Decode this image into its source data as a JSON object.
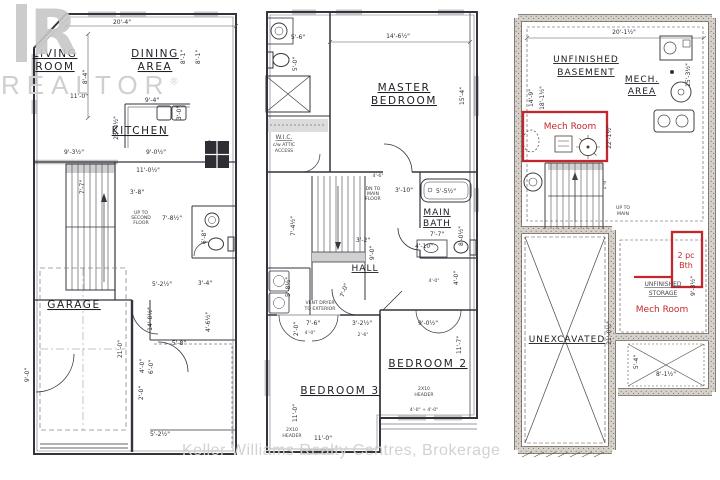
{
  "colors": {
    "annotation_red": "#c2272d",
    "plan_line": "#34343d",
    "watermark_gray": "#cfcfcf"
  },
  "watermarks": {
    "logo_letter": "R",
    "realtor": "REALTOR",
    "registered": "®",
    "footer": "Keller Williams Realty Centres, Brokerage"
  },
  "floor1": {
    "title": "Main Floor",
    "labels": [
      {
        "t": "LIVING",
        "x": 55,
        "y": 57,
        "c": "room"
      },
      {
        "t": "ROOM",
        "x": 55,
        "y": 70,
        "c": "room"
      },
      {
        "t": "DINING",
        "x": 155,
        "y": 57,
        "c": "room"
      },
      {
        "t": "AREA",
        "x": 155,
        "y": 70,
        "c": "room"
      },
      {
        "t": "KITCHEN",
        "x": 140,
        "y": 134,
        "c": "room"
      },
      {
        "t": "GARAGE",
        "x": 74,
        "y": 308,
        "c": "room"
      },
      {
        "t": "20'-4\"",
        "x": 122,
        "y": 24,
        "c": "dim"
      },
      {
        "t": "8'-4\"",
        "x": 87,
        "y": 77,
        "r": -90,
        "c": "dim"
      },
      {
        "t": "11'-0\"",
        "x": 79,
        "y": 98,
        "c": "dim"
      },
      {
        "t": "8'-1\"",
        "x": 185,
        "y": 57,
        "r": -90,
        "c": "dim"
      },
      {
        "t": "8'-1\"",
        "x": 200,
        "y": 57,
        "r": -90,
        "c": "dim"
      },
      {
        "t": "9'-4\"",
        "x": 152,
        "y": 102,
        "c": "dim"
      },
      {
        "t": "3'-0\"",
        "x": 181,
        "y": 113,
        "r": -90,
        "c": "dim"
      },
      {
        "t": "23'-4½\"",
        "x": 118,
        "y": 128,
        "r": -90,
        "c": "dim"
      },
      {
        "t": "9'-0½\"",
        "x": 156,
        "y": 154,
        "c": "dim"
      },
      {
        "t": "9'-3½\"",
        "x": 74,
        "y": 154,
        "c": "dim"
      },
      {
        "t": "6'-4\"",
        "x": 213,
        "y": 147,
        "r": -90,
        "c": "dim"
      },
      {
        "t": "11'-0½\"",
        "x": 148,
        "y": 172,
        "c": "dim"
      },
      {
        "t": "3'-8\"",
        "x": 137,
        "y": 194,
        "c": "dim"
      },
      {
        "t": "UP TO",
        "x": 141,
        "y": 214,
        "c": "tiny"
      },
      {
        "t": "SECOND",
        "x": 141,
        "y": 219,
        "c": "tiny"
      },
      {
        "t": "FLOOR",
        "x": 141,
        "y": 224,
        "c": "tiny"
      },
      {
        "t": "7'-8½\"",
        "x": 172,
        "y": 220,
        "c": "dim"
      },
      {
        "t": "7'-7\"",
        "x": 84,
        "y": 187,
        "r": -90,
        "c": "dim"
      },
      {
        "t": "6'-8\"",
        "x": 206,
        "y": 237,
        "r": -90,
        "c": "dim"
      },
      {
        "t": "5'-2½\"",
        "x": 162,
        "y": 286,
        "c": "dim"
      },
      {
        "t": "3'-4\"",
        "x": 205,
        "y": 285,
        "c": "dim"
      },
      {
        "t": "14'-0½\"",
        "x": 152,
        "y": 319,
        "r": -90,
        "c": "dim"
      },
      {
        "t": "4'-6½\"",
        "x": 210,
        "y": 322,
        "r": -90,
        "c": "dim"
      },
      {
        "t": "21'-0\"",
        "x": 122,
        "y": 349,
        "r": -90,
        "c": "dim"
      },
      {
        "t": "5'-8\"",
        "x": 179,
        "y": 345,
        "c": "dim"
      },
      {
        "t": "4'-0\"",
        "x": 144,
        "y": 366,
        "r": -90,
        "c": "dim"
      },
      {
        "t": "6'-0\"",
        "x": 153,
        "y": 367,
        "r": -90,
        "c": "dim"
      },
      {
        "t": "2'-0\"",
        "x": 143,
        "y": 393,
        "r": -90,
        "c": "dim"
      },
      {
        "t": "9'-0\"",
        "x": 29,
        "y": 375,
        "r": -90,
        "c": "dim"
      },
      {
        "t": "5'-2½\"",
        "x": 160,
        "y": 436,
        "c": "dim"
      }
    ]
  },
  "floor2": {
    "title": "Second Floor",
    "labels": [
      {
        "t": "MASTER",
        "x": 404,
        "y": 91,
        "c": "room"
      },
      {
        "t": "BEDROOM",
        "x": 404,
        "y": 104,
        "c": "room"
      },
      {
        "t": "W.I.C.",
        "x": 284,
        "y": 139,
        "c": "tiny2"
      },
      {
        "t": "c/w ATTIC",
        "x": 284,
        "y": 146,
        "c": "tiny"
      },
      {
        "t": "ACCESS",
        "x": 284,
        "y": 152,
        "c": "tiny"
      },
      {
        "t": "5'-6\"",
        "x": 298,
        "y": 39,
        "c": "dim"
      },
      {
        "t": "5'-0\"",
        "x": 297,
        "y": 64,
        "r": -90,
        "c": "dim"
      },
      {
        "t": "14'-6½\"",
        "x": 398,
        "y": 38,
        "c": "dim"
      },
      {
        "t": "15'-4\"",
        "x": 464,
        "y": 96,
        "r": -90,
        "c": "dim"
      },
      {
        "t": "DN TO",
        "x": 373,
        "y": 190,
        "c": "tiny"
      },
      {
        "t": "MAIN",
        "x": 373,
        "y": 195,
        "c": "tiny"
      },
      {
        "t": "FLOOR",
        "x": 373,
        "y": 200,
        "c": "tiny"
      },
      {
        "t": "4'-6\"",
        "x": 378,
        "y": 177,
        "c": "tiny"
      },
      {
        "t": "3'-10\"",
        "x": 404,
        "y": 192,
        "c": "dim"
      },
      {
        "t": "5'-5½\"",
        "x": 446,
        "y": 193,
        "c": "dim"
      },
      {
        "t": "MAIN",
        "x": 437,
        "y": 215,
        "c": "room-s"
      },
      {
        "t": "BATH",
        "x": 437,
        "y": 226,
        "c": "room-s"
      },
      {
        "t": "7'-7\"",
        "x": 437,
        "y": 236,
        "c": "dim"
      },
      {
        "t": "7'-4½\"",
        "x": 295,
        "y": 226,
        "r": -90,
        "c": "dim"
      },
      {
        "t": "3'-2\"",
        "x": 363,
        "y": 242,
        "c": "dim"
      },
      {
        "t": "9'-0\"",
        "x": 374,
        "y": 253,
        "r": -90,
        "c": "dim"
      },
      {
        "t": "4'-10\"",
        "x": 424,
        "y": 248,
        "c": "dim"
      },
      {
        "t": "8'-0½\"",
        "x": 463,
        "y": 236,
        "r": -90,
        "c": "dim"
      },
      {
        "t": "HALL",
        "x": 365,
        "y": 271,
        "c": "room-s"
      },
      {
        "t": "5'-8½\"",
        "x": 290,
        "y": 287,
        "r": -90,
        "c": "dim"
      },
      {
        "t": "VENT DRYER",
        "x": 320,
        "y": 304,
        "c": "tiny"
      },
      {
        "t": "TO EXTERIOR",
        "x": 320,
        "y": 310,
        "c": "tiny"
      },
      {
        "t": "7'-0\"",
        "x": 346,
        "y": 291,
        "r": -70,
        "c": "dim"
      },
      {
        "t": "4'-0\"",
        "x": 458,
        "y": 278,
        "r": -90,
        "c": "dim"
      },
      {
        "t": "4'-0\"",
        "x": 434,
        "y": 282,
        "c": "tiny"
      },
      {
        "t": "7'-6\"",
        "x": 313,
        "y": 325,
        "c": "dim"
      },
      {
        "t": "2'-0\"",
        "x": 298,
        "y": 329,
        "r": -90,
        "c": "dim"
      },
      {
        "t": "4'-0\"",
        "x": 310,
        "y": 334,
        "c": "tiny"
      },
      {
        "t": "3'-2½\"",
        "x": 362,
        "y": 325,
        "c": "dim"
      },
      {
        "t": "2'-6\"",
        "x": 363,
        "y": 336,
        "c": "tiny"
      },
      {
        "t": "9'-0½\"",
        "x": 428,
        "y": 325,
        "c": "dim"
      },
      {
        "t": "BEDROOM 2",
        "x": 428,
        "y": 367,
        "c": "room"
      },
      {
        "t": "2X10",
        "x": 424,
        "y": 390,
        "c": "tiny"
      },
      {
        "t": "HEADER",
        "x": 424,
        "y": 396,
        "c": "tiny"
      },
      {
        "t": "11'-7\"",
        "x": 461,
        "y": 345,
        "r": -90,
        "c": "dim"
      },
      {
        "t": "BEDROOM 3",
        "x": 340,
        "y": 394,
        "c": "room"
      },
      {
        "t": "11'-0\"",
        "x": 297,
        "y": 413,
        "r": -90,
        "c": "dim"
      },
      {
        "t": "2X10",
        "x": 292,
        "y": 431,
        "c": "tiny"
      },
      {
        "t": "HEADER",
        "x": 292,
        "y": 437,
        "c": "tiny"
      },
      {
        "t": "11'-0\"",
        "x": 323,
        "y": 440,
        "c": "dim"
      },
      {
        "t": "4'-0\" + 4'-0\"",
        "x": 424,
        "y": 411,
        "c": "tiny"
      }
    ]
  },
  "floor3": {
    "title": "Basement",
    "labels": [
      {
        "t": "UNFINISHED",
        "x": 586,
        "y": 62,
        "c": "room-s"
      },
      {
        "t": "BASEMENT",
        "x": 586,
        "y": 75,
        "c": "room-s"
      },
      {
        "t": "MECH.",
        "x": 642,
        "y": 82,
        "c": "room-s"
      },
      {
        "t": "AREA",
        "x": 642,
        "y": 94,
        "c": "room-s"
      },
      {
        "t": "20'-1½\"",
        "x": 624,
        "y": 34,
        "c": "dim"
      },
      {
        "t": "14'-9\"",
        "x": 533,
        "y": 98,
        "r": -90,
        "c": "dim"
      },
      {
        "t": "18'-1½\"",
        "x": 544,
        "y": 98,
        "r": -90,
        "c": "dim"
      },
      {
        "t": "15'-3½\"",
        "x": 690,
        "y": 75,
        "r": -90,
        "c": "dim"
      },
      {
        "t": "22'-1½\"",
        "x": 611,
        "y": 137,
        "r": -90,
        "c": "dim"
      },
      {
        "t": "Mech Room",
        "x": 570,
        "y": 129,
        "c": "red"
      },
      {
        "t": "UP TO",
        "x": 623,
        "y": 209,
        "c": "tiny"
      },
      {
        "t": "MAIN",
        "x": 623,
        "y": 215,
        "c": "tiny"
      },
      {
        "t": "1'-0\"",
        "x": 606,
        "y": 184,
        "r": -90,
        "c": "tiny"
      },
      {
        "t": "2 pc",
        "x": 686,
        "y": 258,
        "c": "red-s"
      },
      {
        "t": "Bth",
        "x": 686,
        "y": 268,
        "c": "red-s"
      },
      {
        "t": "UNFINISHED",
        "x": 663,
        "y": 286,
        "c": "tiny2"
      },
      {
        "t": "STORAGE",
        "x": 663,
        "y": 295,
        "c": "tiny2"
      },
      {
        "t": "9'-3½\"",
        "x": 695,
        "y": 286,
        "r": -90,
        "c": "dim"
      },
      {
        "t": "Mech Room",
        "x": 662,
        "y": 312,
        "c": "red"
      },
      {
        "t": "UNEXCAVATED",
        "x": 567,
        "y": 342,
        "c": "room-s"
      },
      {
        "t": "21'-0½\"",
        "x": 611,
        "y": 333,
        "r": -90,
        "c": "dim"
      },
      {
        "t": "5'-4\"",
        "x": 638,
        "y": 362,
        "r": -90,
        "c": "dim"
      },
      {
        "t": "8'-1½\"",
        "x": 666,
        "y": 376,
        "c": "dim"
      }
    ]
  }
}
